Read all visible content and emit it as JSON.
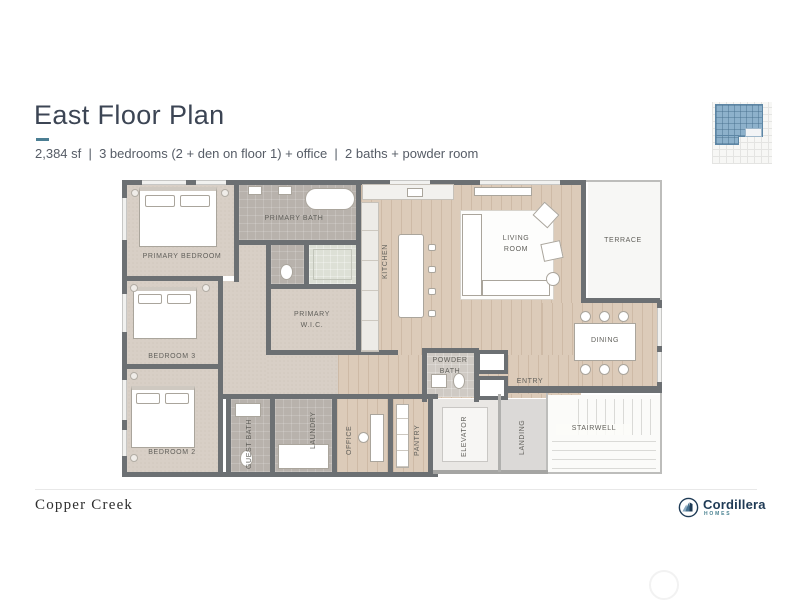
{
  "header": {
    "title": "East Floor Plan",
    "subtitle": "2,384 sf  |  3 bedrooms (2 + den on floor 1) + office  |  2 baths + powder room"
  },
  "rooms": {
    "primary_bedroom": {
      "label": "PRIMARY BEDROOM"
    },
    "primary_bath": {
      "label": "PRIMARY BATH"
    },
    "primary_wic": {
      "label": "PRIMARY W.I.C."
    },
    "bedroom_3": {
      "label": "BEDROOM 3"
    },
    "bedroom_2": {
      "label": "BEDROOM 2"
    },
    "guest_bath": {
      "label": "GUEST BATH"
    },
    "laundry": {
      "label": "LAUNDRY"
    },
    "office": {
      "label": "OFFICE"
    },
    "pantry": {
      "label": "PANTRY"
    },
    "kitchen": {
      "label": "KITCHEN"
    },
    "living_room": {
      "label": "LIVING ROOM"
    },
    "terrace": {
      "label": "TERRACE"
    },
    "dining": {
      "label": "DINING"
    },
    "powder_bath": {
      "label": "POWDER BATH"
    },
    "entry": {
      "label": "ENTRY"
    },
    "elevator": {
      "label": "ELEVATOR"
    },
    "landing": {
      "label": "LANDING"
    },
    "stairwell": {
      "label": "STAIRWELL"
    }
  },
  "footer": {
    "community": "Copper Creek",
    "brand": "Cordillera",
    "brand_tagline": "HOMES"
  },
  "colors": {
    "accent": "#4b7e93",
    "title": "#3c4554",
    "wall": "#6c7073",
    "wood_floor": "#dccbb9",
    "carpet_floor": "#d8cfc6",
    "tile_floor": "#b8b2ac",
    "brand_navy": "#1e3a55",
    "brand_teal": "#4a8291",
    "keyplan_highlight": "#8db1cb"
  }
}
